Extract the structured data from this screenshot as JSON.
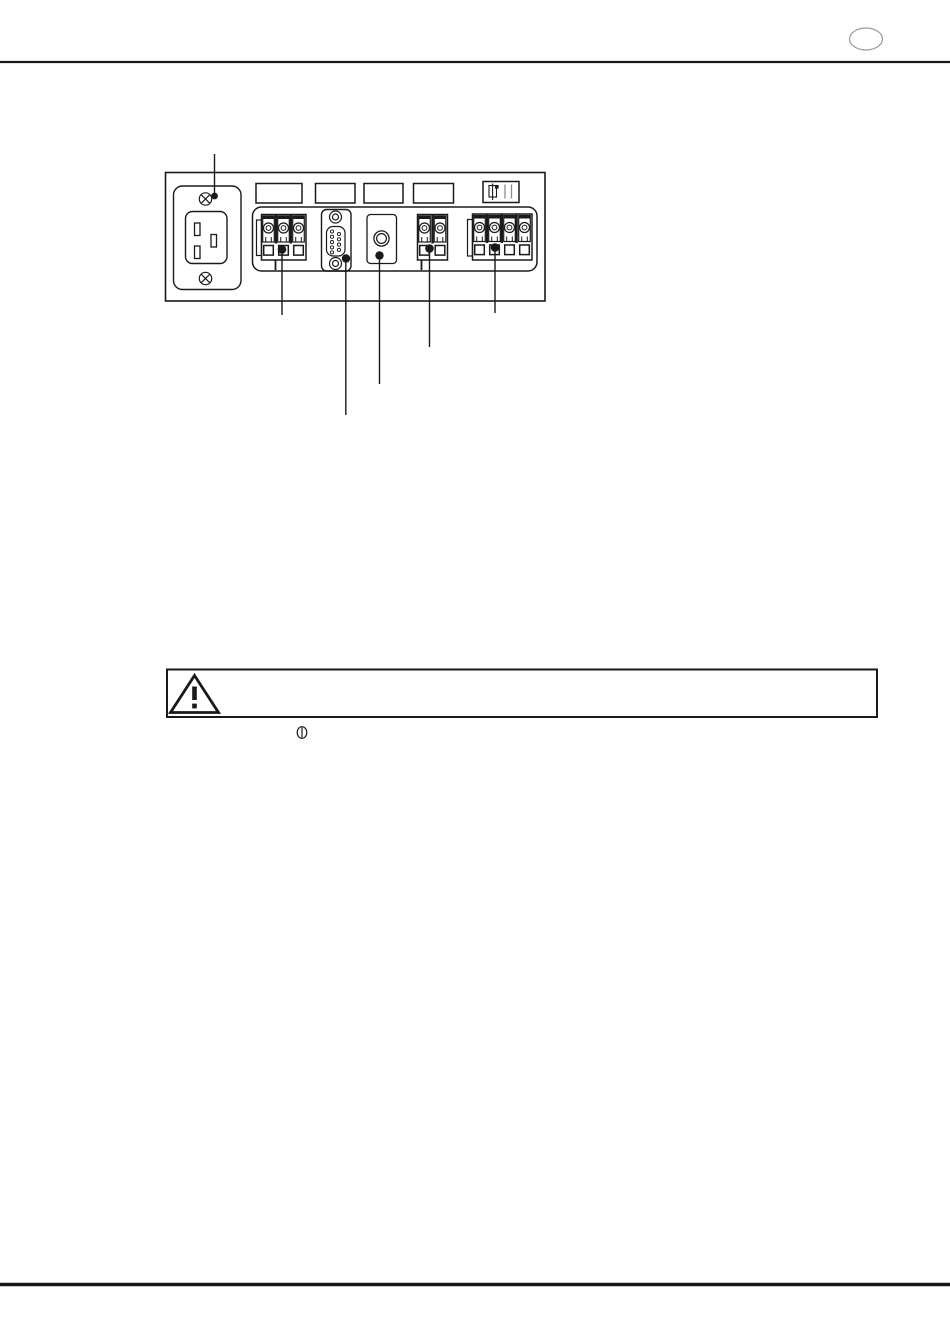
{
  "page": {
    "kind": "scanned equipment manual page",
    "page_number_label": ""
  },
  "colors": {
    "ink": "#1a1a1a",
    "page_background": "#ffffff",
    "oval_gray": "#9a9a9a",
    "plate_icon_gray": "#8c8c8c"
  },
  "figure": {
    "caption": "",
    "label_plates": [
      "",
      "",
      "",
      "",
      ""
    ],
    "components": [
      "ac-power-inlet",
      "terminal-block-3pole",
      "db9-serial-connector",
      "coaxial-connector",
      "terminal-block-2pole",
      "terminal-block-4pole"
    ],
    "callout_count": 6
  },
  "warning_box": {
    "text": ""
  },
  "symbols": [
    "warning-triangle",
    "power-on"
  ]
}
